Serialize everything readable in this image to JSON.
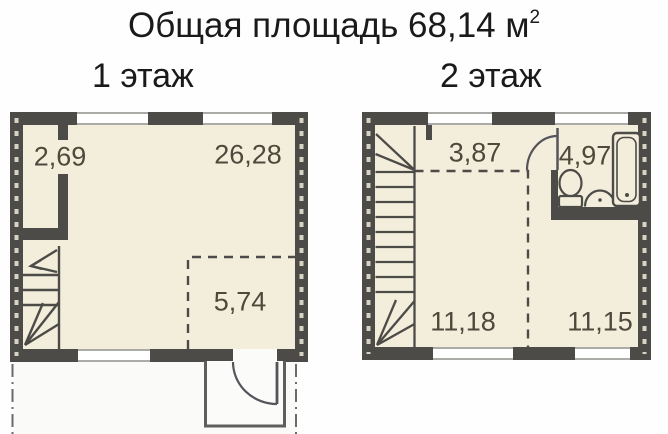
{
  "title": {
    "text": "Общая площадь 68,14 м",
    "superscript": "2"
  },
  "floor1": {
    "label": "1 этаж",
    "areas": {
      "closet": "2,69",
      "main_room": "26,28",
      "kitchen_zone": "5,74"
    }
  },
  "floor2": {
    "label": "2 этаж",
    "areas": {
      "hall": "3,87",
      "bathroom": "4,97",
      "room_left": "11,18",
      "room_right": "11,15"
    }
  },
  "icons": {
    "staircase": "staircase-icon",
    "toilet": "toilet-icon",
    "sink": "sink-icon",
    "bathtub": "bathtub-icon",
    "door_swing": "door-arc-icon",
    "window": "window-icon"
  },
  "colors": {
    "wall": "#4C4B48",
    "floor_fill": "#F3EEDB",
    "label_text": "#4E483D",
    "title_text": "#1A1A1A",
    "background": "#FEFEFE",
    "site_boundary_line": "#6B6B69"
  }
}
